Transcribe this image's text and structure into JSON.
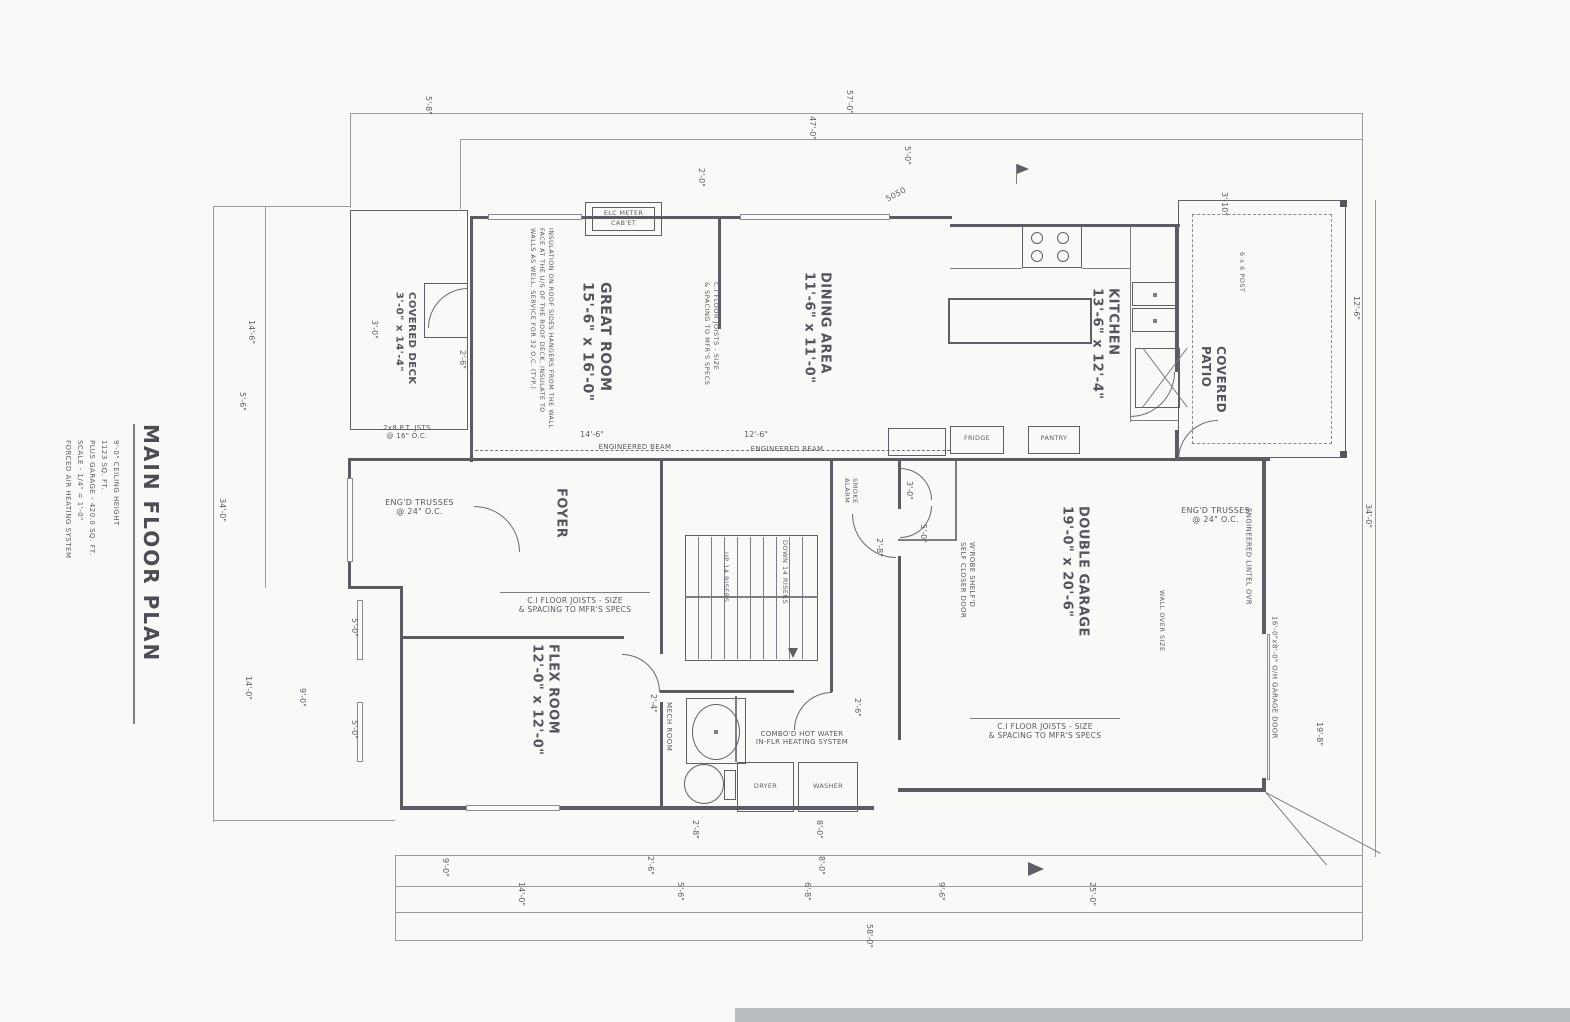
{
  "page": {
    "background": "#f9f9f7",
    "ink": "#5b5b63",
    "scan_strip": "#b8bcc1"
  },
  "title_block": {
    "title": "MAIN FLOOR PLAN",
    "notes": "9'-0\" CEILING HEIGHT\n1123 SQ. FT.\nPLUS GARAGE - 420.0 SQ. FT.\nSCALE - 1/4\" = 1'-0\"\nFORCED AIR HEATING SYSTEM"
  },
  "rooms": {
    "covered_deck": {
      "label": "COVERED DECK\n3'-0\" x 14'-4\""
    },
    "great_room": {
      "label": "GREAT ROOM\n15'-6\" x 16'-0\""
    },
    "dining_area": {
      "label": "DINING AREA\n11'-6\" x 11'-0\""
    },
    "kitchen": {
      "label": "KITCHEN\n13'-6\" x 12'-4\""
    },
    "covered_patio": {
      "label": "COVERED\nPATIO"
    },
    "foyer": {
      "label": "FOYER"
    },
    "flex_room": {
      "label": "FLEX ROOM\n12'-0\" x 12'-0\""
    },
    "double_garage": {
      "label": "DOUBLE GARAGE\n19'-0\" x 20'-6\""
    },
    "mech_room": {
      "label": "MECH ROOM"
    }
  },
  "stairs": {
    "up": "UP 14 RISERS",
    "down": "DOWN 14 RISERS"
  },
  "appliances": {
    "dryer": "DRYER",
    "washer": "WASHER",
    "fridge": "FRIDGE",
    "pantry": "PANTRY",
    "elec_meter": "ELC METER\nCAB'ET"
  },
  "notes": {
    "engineered_beam_left": "ENGINEERED BEAM",
    "engineered_beam_right": "ENGINEERED BEAM",
    "trusses_left": "ENG'D TRUSSES\n@ 24\" O.C.",
    "trusses_right": "ENG'D TRUSSES\n@ 24\" O.C.",
    "floor_joists_left": "C.I FLOOR JOISTS - SIZE\n& SPACING TO MFR'S SPECS",
    "floor_joists_right": "C.I FLOOR JOISTS - SIZE\n& SPACING TO MFR'S SPECS",
    "floor_joists_wall": "C.I FLOOR JOISTS - SIZE\n& SPACING TO MFR'S SPECS",
    "deck_joists": "2x8 P.T. JSTS\n@ 16\" O.C.",
    "insulation": "INSULATION ON ROOF SIDES HANGERS FROM THE WALL\nFACE AT THE U/S OF THE ROOF DECK, INSULATE TO\nWALLS AS WELL, SERVICE FOR 32 O.C. (TYP.)",
    "water_heater": "COMBO'D HOT WATER\nIN-FLR HEATING SYSTEM",
    "smoke_alarm": "SMOKE\nALARM",
    "wardrobe": "W'ROBE SHELF'D\nSELF CLOSER DOOR",
    "wall_over": "WALL OVER SIZE",
    "lintel": "ENGINEERED LINTEL OVR",
    "garage_door": "16'-0\"x8'-0\" O/H GARAGE DOOR",
    "post": "6 x 6 POST",
    "window_5050": "5050"
  },
  "dimensions": [
    {
      "t": "5'-8\"",
      "x": 424,
      "y": 96
    },
    {
      "t": "57'-0\"",
      "x": 845,
      "y": 90
    },
    {
      "t": "47'-0\"",
      "x": 808,
      "y": 116
    },
    {
      "t": "5'-0\"",
      "x": 903,
      "y": 146
    },
    {
      "t": "2'-0\"",
      "x": 697,
      "y": 168
    },
    {
      "t": "3'-10\"",
      "x": 1220,
      "y": 192
    },
    {
      "t": "14'-6\"",
      "x": 247,
      "y": 320
    },
    {
      "t": "5'-6\"",
      "x": 238,
      "y": 392
    },
    {
      "t": "34'-0\"",
      "x": 218,
      "y": 498
    },
    {
      "t": "3'-0\"",
      "x": 370,
      "y": 320
    },
    {
      "t": "2'-6\"",
      "x": 458,
      "y": 350
    },
    {
      "t": "5'-0\"",
      "x": 350,
      "y": 618
    },
    {
      "t": "5'-0\"",
      "x": 350,
      "y": 720
    },
    {
      "t": "9'-0\"",
      "x": 298,
      "y": 688
    },
    {
      "t": "14'-0\"",
      "x": 244,
      "y": 676
    },
    {
      "t": "9'-0\"",
      "x": 441,
      "y": 858
    },
    {
      "t": "14'-0\"",
      "x": 517,
      "y": 882
    },
    {
      "t": "2'-6\"",
      "x": 646,
      "y": 856
    },
    {
      "t": "5'-6\"",
      "x": 676,
      "y": 882
    },
    {
      "t": "8'-0\"",
      "x": 817,
      "y": 856
    },
    {
      "t": "6'-8\"",
      "x": 803,
      "y": 882
    },
    {
      "t": "9'-6\"",
      "x": 937,
      "y": 882
    },
    {
      "t": "25'-0\"",
      "x": 1088,
      "y": 882
    },
    {
      "t": "58'-0\"",
      "x": 865,
      "y": 924
    },
    {
      "t": "12'-6\"",
      "x": 1352,
      "y": 296
    },
    {
      "t": "34'-0\"",
      "x": 1364,
      "y": 504
    },
    {
      "t": "19'-8\"",
      "x": 1315,
      "y": 722
    },
    {
      "t": "14'-6\"",
      "x": 580,
      "y": 430,
      "o": "h"
    },
    {
      "t": "12'-6\"",
      "x": 744,
      "y": 430,
      "o": "h"
    },
    {
      "t": "2'-8\"",
      "x": 875,
      "y": 538
    },
    {
      "t": "2'-4\"",
      "x": 649,
      "y": 694
    },
    {
      "t": "2'-6\"",
      "x": 853,
      "y": 698
    },
    {
      "t": "2'-8\"",
      "x": 691,
      "y": 820
    },
    {
      "t": "8'-0\"",
      "x": 815,
      "y": 820
    },
    {
      "t": "5'-0\"",
      "x": 919,
      "y": 524
    },
    {
      "t": "3'-0\"",
      "x": 905,
      "y": 481
    }
  ]
}
